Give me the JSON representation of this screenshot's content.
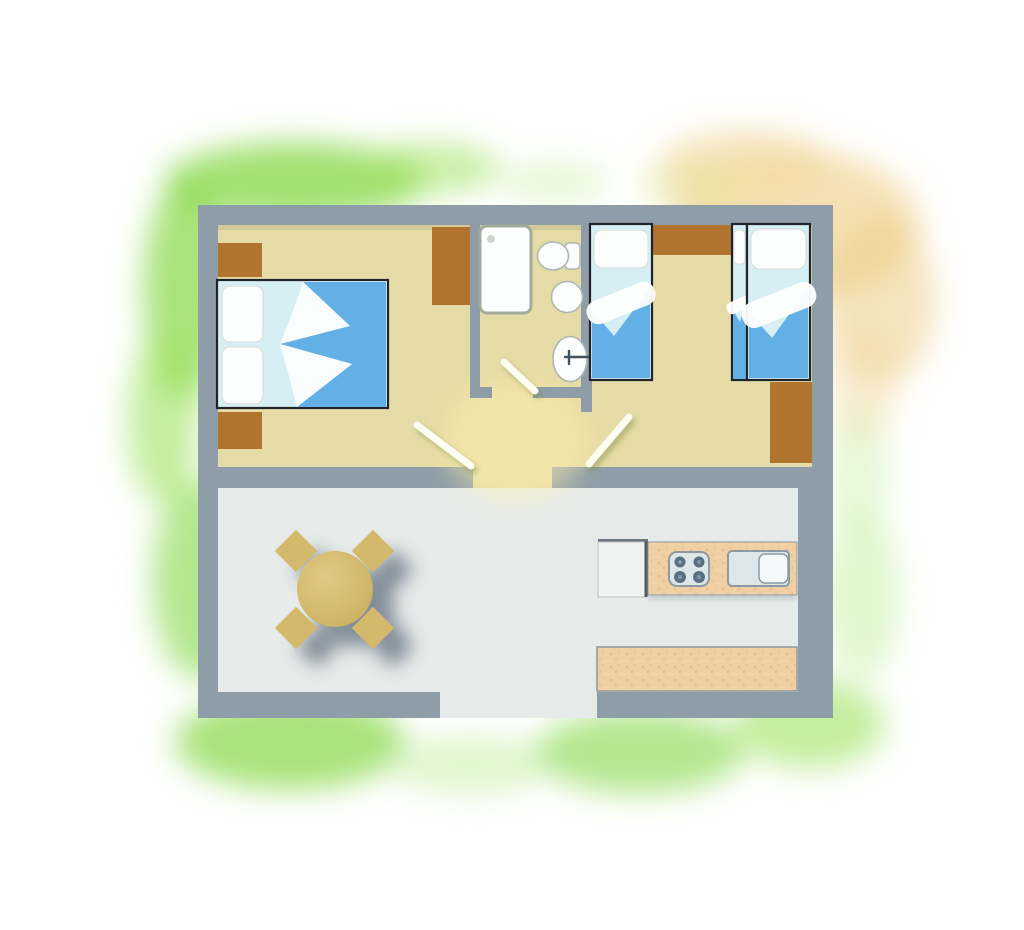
{
  "title": "holiday-home-floor-plan",
  "palette": {
    "wall": "#8e9da7",
    "floor_bedrooms": "#e5dba6",
    "floor_living": "#e6ebe9",
    "hall_glow": "#ffefab",
    "furniture_brown": "#b0742e",
    "wood": "#f0cfa2",
    "wood_speckle": "#dfb68b",
    "chair": "#d4b96d",
    "table_light": "#dfc983",
    "table_dark": "#ccb161",
    "duvet": "#63b0e7",
    "sheet": "#d6eff4",
    "pillow": "#fcfdfd",
    "outline_dark": "#20242a",
    "fixture_white": "#fdfefe",
    "fixture_stroke": "#adb7b2",
    "shower_stroke": "#a3ab9b",
    "tap": "#43525e",
    "appliance": "#dde7ea",
    "appliance_stroke": "#8b9aa4",
    "burner": "#5a7081",
    "burner_center": "#8496a3",
    "fridge": "#eef2f1",
    "fridge_edge": "#4e5a64",
    "door": "#fdfdf3",
    "door_shadow": "#75853e",
    "shadow": "#33435a",
    "wash_green_1": "#84d743",
    "wash_green_2": "#9fe25f",
    "wash_green_3": "#c4efa0",
    "wash_yellow_1": "#f2daa2",
    "wash_yellow_2": "#eccd87",
    "wash_yellow_3": "#e6e49a"
  },
  "plan": {
    "type": "top-down floor plan, no text labels",
    "rooms": [
      {
        "name": "master-bedroom",
        "furniture": [
          "double-bed",
          "nightstand-top",
          "nightstand-bottom",
          "wardrobe"
        ]
      },
      {
        "name": "bathroom",
        "furniture": [
          "shower",
          "toilet-with-cistern",
          "bidet",
          "washbasin-with-tap"
        ]
      },
      {
        "name": "hallway",
        "furniture": [
          "bedroom-door",
          "bathroom-door",
          "kids-room-door"
        ]
      },
      {
        "name": "children-bedroom",
        "furniture": [
          "single-bed-left",
          "cabinet-between-beds",
          "single-bed-sliver",
          "single-bed-right",
          "wardrobe"
        ]
      },
      {
        "name": "living-kitchen",
        "furniture": [
          "round-table",
          "four-chairs",
          "fridge",
          "counter-with-stove-and-sink",
          "lower-counter"
        ]
      },
      {
        "name": "entrance-opening",
        "furniture": []
      }
    ],
    "surroundings": "green watercolor lawn wash around building, yellow-orange wash at top right"
  }
}
